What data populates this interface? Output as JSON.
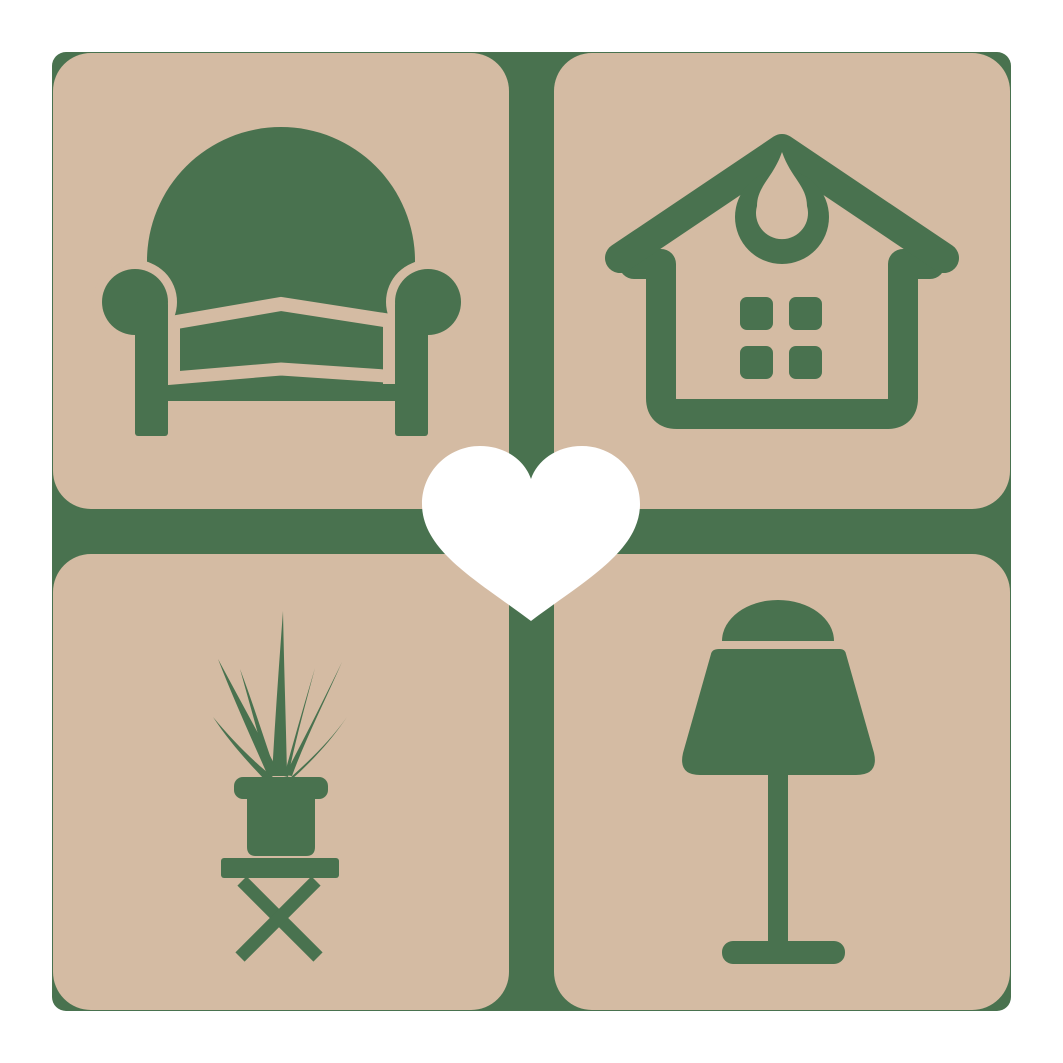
{
  "logo": {
    "kind": "home-decor-logo",
    "tiles": [
      {
        "position": "top-left",
        "icon": "armchair-icon"
      },
      {
        "position": "top-right",
        "icon": "house-icon"
      },
      {
        "position": "bottom-left",
        "icon": "potted-plant-icon"
      },
      {
        "position": "bottom-right",
        "icon": "table-lamp-icon"
      }
    ],
    "center": {
      "icon": "heart-icon"
    }
  },
  "colors": {
    "page_background": "#ffffff",
    "base_green": "#49724f",
    "tile_tan": "#d4bba3",
    "heart_white": "#ffffff"
  }
}
